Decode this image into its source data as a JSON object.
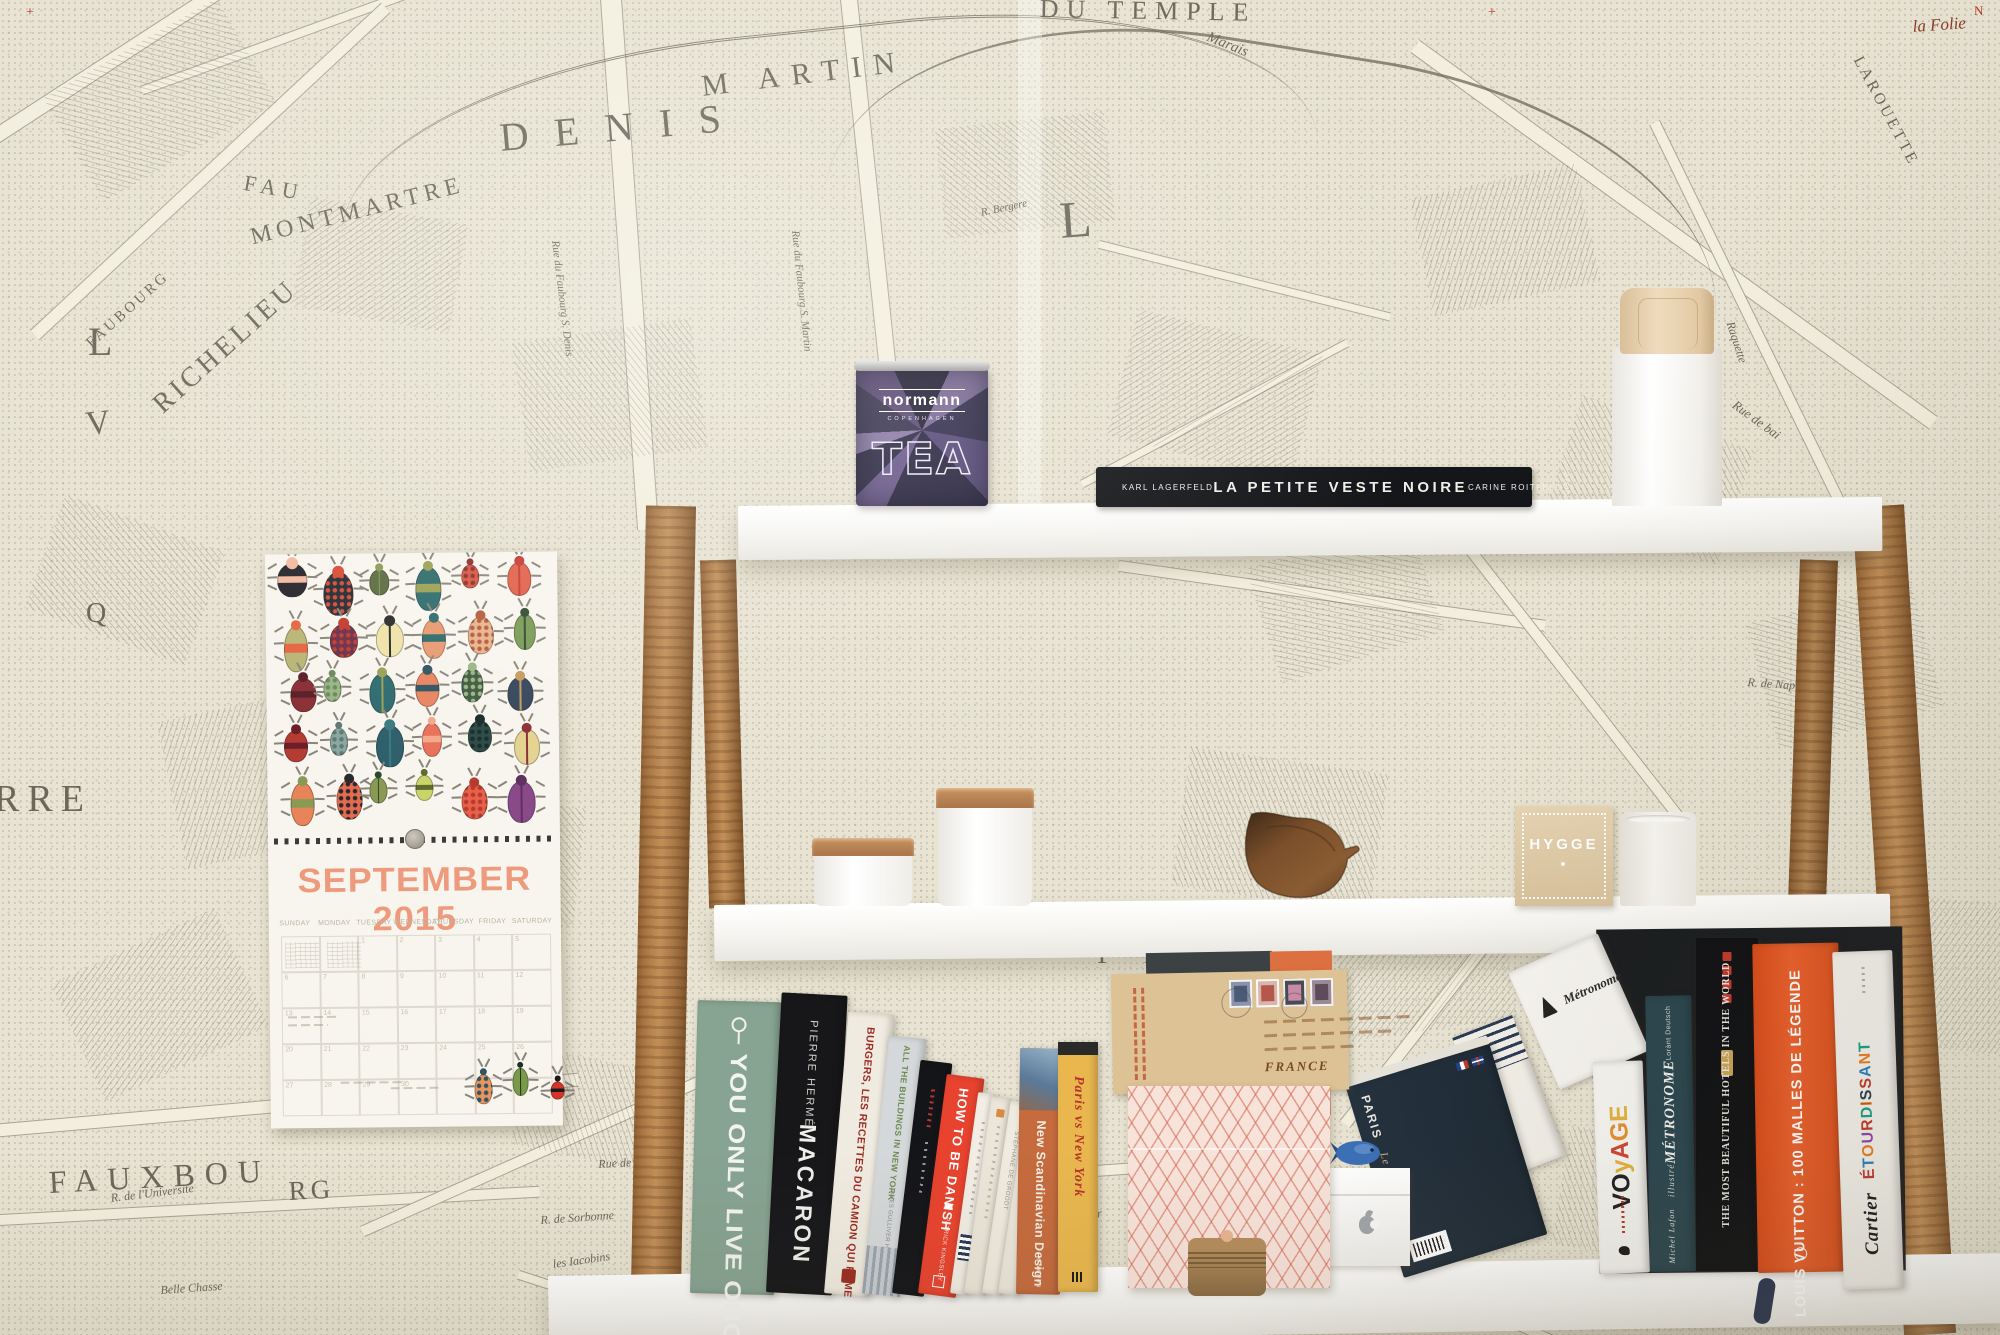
{
  "colors": {
    "wallpaper": "#e8e3d2",
    "ink": "#6b675a",
    "street": "#f3efdf",
    "plank": "#f7f6f2",
    "wood": "#b8854e",
    "calendar_title": "#ee9b7d",
    "tea_purple": "#3a3550",
    "hygge_kraft": "#dcc6a2",
    "vuitton_orange": "#e5531f",
    "danish_red": "#e8432e"
  },
  "wallpaper": {
    "labels": [
      {
        "t": "DENIS",
        "x": 498,
        "y": 118,
        "s": 40,
        "r": -5,
        "ls": 26
      },
      {
        "t": "M ARTIN",
        "x": 700,
        "y": 72,
        "s": 30,
        "r": -7,
        "ls": 12
      },
      {
        "t": "DU TEMPLE",
        "x": 1040,
        "y": -4,
        "s": 26,
        "r": 1,
        "ls": 8
      },
      {
        "t": "Marais",
        "x": 1210,
        "y": 30,
        "s": 15,
        "r": 22,
        "i": 1
      },
      {
        "t": "MONTMARTRE",
        "x": 248,
        "y": 226,
        "s": 24,
        "r": -14,
        "ls": 5
      },
      {
        "t": "RICHELIEU",
        "x": 148,
        "y": 398,
        "s": 28,
        "r": -42,
        "ls": 4
      },
      {
        "t": "FAUBOURG",
        "x": 84,
        "y": 340,
        "s": 15,
        "r": -42,
        "ls": 3
      },
      {
        "t": "FAU",
        "x": 246,
        "y": 172,
        "s": 22,
        "r": 10,
        "ls": 6
      },
      {
        "t": "L",
        "x": 88,
        "y": 322,
        "s": 40,
        "r": 0
      },
      {
        "t": "L",
        "x": 1058,
        "y": 196,
        "s": 52,
        "r": -4
      },
      {
        "t": "V",
        "x": 84,
        "y": 408,
        "s": 34,
        "r": -6
      },
      {
        "t": "Q",
        "x": 86,
        "y": 600,
        "s": 28,
        "r": 0
      },
      {
        "t": "RRE",
        "x": -6,
        "y": 780,
        "s": 38,
        "r": 0,
        "ls": 8
      },
      {
        "t": "FAUXBOU",
        "x": 48,
        "y": 1166,
        "s": 32,
        "r": -3,
        "ls": 10
      },
      {
        "t": "RG",
        "x": 288,
        "y": 1178,
        "s": 27,
        "r": -3,
        "ls": 4
      },
      {
        "t": "U",
        "x": 1448,
        "y": 1086,
        "s": 54,
        "r": 8
      },
      {
        "t": "R.",
        "x": 1142,
        "y": 1200,
        "s": 32,
        "r": 0
      },
      {
        "t": "T",
        "x": 1330,
        "y": 1288,
        "s": 34,
        "r": 0
      },
      {
        "t": "T E",
        "x": 1094,
        "y": 942,
        "s": 26,
        "r": 0,
        "ls": 14
      },
      {
        "t": "LAROUETTE",
        "x": 1864,
        "y": 54,
        "s": 16,
        "r": 62,
        "ls": 3
      },
      {
        "t": "la Folie",
        "x": 1912,
        "y": 18,
        "s": 17,
        "r": -4,
        "i": 1,
        "c": "#8a3a28"
      },
      {
        "t": "Rue de Vernouil",
        "x": 598,
        "y": 1158,
        "s": 12,
        "r": -3,
        "i": 1
      },
      {
        "t": "R. de Sorbonne",
        "x": 540,
        "y": 1214,
        "s": 12,
        "r": -4,
        "i": 1
      },
      {
        "t": "R. de l'Universite",
        "x": 110,
        "y": 1192,
        "s": 12,
        "r": -7,
        "i": 1
      },
      {
        "t": "Belle Chasse",
        "x": 160,
        "y": 1284,
        "s": 12,
        "r": -4,
        "i": 1
      },
      {
        "t": "R. Iacob",
        "x": 850,
        "y": 1208,
        "s": 12,
        "r": -4,
        "i": 1
      },
      {
        "t": "R. du Colombier",
        "x": 1022,
        "y": 1218,
        "s": 12,
        "r": -8,
        "i": 1
      },
      {
        "t": "les Iacobins",
        "x": 552,
        "y": 1258,
        "s": 12,
        "r": -8,
        "i": 1
      },
      {
        "t": "Augustins",
        "x": 834,
        "y": 1172,
        "s": 12,
        "r": -4,
        "i": 1
      },
      {
        "t": "R. des Marais",
        "x": 1258,
        "y": 1164,
        "s": 12,
        "r": -12,
        "i": 1
      },
      {
        "t": "R. de Bussi",
        "x": 1292,
        "y": 1228,
        "s": 12,
        "r": -34,
        "i": 1
      },
      {
        "t": "Raquette",
        "x": 1736,
        "y": 320,
        "s": 12,
        "r": 72,
        "i": 1
      },
      {
        "t": "Rue de bai",
        "x": 1738,
        "y": 398,
        "s": 13,
        "r": 36,
        "i": 1
      },
      {
        "t": "R. de Naples",
        "x": 1748,
        "y": 676,
        "s": 12,
        "r": 4,
        "i": 1
      },
      {
        "t": "Rue du Faubourg S. Denis",
        "x": 560,
        "y": 240,
        "s": 11,
        "r": 83,
        "i": 1
      },
      {
        "t": "Rue du Faubourg S. Martin",
        "x": 800,
        "y": 230,
        "s": 11,
        "r": 84,
        "i": 1
      },
      {
        "t": "R. Bergere",
        "x": 980,
        "y": 208,
        "s": 11,
        "r": -12,
        "i": 1
      },
      {
        "t": "R. de Sorbet",
        "x": 1240,
        "y": 470,
        "s": 11,
        "r": 6,
        "i": 1
      },
      {
        "t": "+",
        "x": 26,
        "y": 6,
        "s": 14,
        "r": 0,
        "c": "#b5362a"
      },
      {
        "t": "+",
        "x": 1488,
        "y": 6,
        "s": 14,
        "r": 0,
        "c": "#b5362a"
      },
      {
        "t": "N",
        "x": 1974,
        "y": 4,
        "s": 13,
        "r": 0,
        "c": "#b5362a"
      }
    ]
  },
  "calendar": {
    "title": "SEPTEMBER 2015",
    "weekdays": [
      "SUNDAY",
      "MONDAY",
      "TUESDAY",
      "WEDNESDAY",
      "THURSDAY",
      "FRIDAY",
      "SATURDAY"
    ],
    "days": [
      [
        "",
        "",
        "1",
        "2",
        "3",
        "4",
        "5"
      ],
      [
        "6",
        "7",
        "8",
        "9",
        "10",
        "11",
        "12"
      ],
      [
        "13",
        "14",
        "15",
        "16",
        "17",
        "18",
        "19"
      ],
      [
        "20",
        "21",
        "22",
        "23",
        "24",
        "25",
        "26"
      ],
      [
        "27",
        "28",
        "29",
        "30",
        "",
        "",
        ""
      ]
    ],
    "beetles": [
      {
        "b": "#26242b",
        "a": "#f2b9a0",
        "w": 30,
        "h": 34
      },
      {
        "b": "#232b33",
        "a": "#d84b35",
        "w": 30,
        "h": 44
      },
      {
        "b": "#5b6b3f",
        "a": "#8a9a55",
        "w": 20,
        "h": 26
      },
      {
        "b": "#2e6b6b",
        "a": "#9aa055",
        "w": 26,
        "h": 44
      },
      {
        "b": "#d85540",
        "a": "#8a2f28",
        "w": 18,
        "h": 24
      },
      {
        "b": "#e2604a",
        "a": "#c43a30",
        "w": 24,
        "h": 34
      },
      {
        "b": "#b9b575",
        "a": "#e5653f",
        "w": 24,
        "h": 46
      },
      {
        "b": "#6b2f4a",
        "a": "#c23b2d",
        "w": 28,
        "h": 34
      },
      {
        "b": "#efe3a8",
        "a": "#2a2a2a",
        "w": 28,
        "h": 36
      },
      {
        "b": "#e89a70",
        "a": "#2e6b6b",
        "w": 24,
        "h": 40
      },
      {
        "b": "#e8b48a",
        "a": "#b55a3f",
        "w": 26,
        "h": 38
      },
      {
        "b": "#7a9a55",
        "a": "#2f4a2f",
        "w": 22,
        "h": 36
      },
      {
        "b": "#8a2f35",
        "a": "#5a1f28",
        "w": 26,
        "h": 34
      },
      {
        "b": "#9ab585",
        "a": "#6b8a5f",
        "w": 18,
        "h": 26
      },
      {
        "b": "#2e6b70",
        "a": "#9aa055",
        "w": 26,
        "h": 40
      },
      {
        "b": "#e8845f",
        "a": "#2e5560",
        "w": 24,
        "h": 36
      },
      {
        "b": "#3f5a3f",
        "a": "#9ab585",
        "w": 22,
        "h": 34
      },
      {
        "b": "#35455a",
        "a": "#c69a60",
        "w": 26,
        "h": 34
      },
      {
        "b": "#b53b35",
        "a": "#6b1f28",
        "w": 24,
        "h": 32
      },
      {
        "b": "#8aa7a0",
        "a": "#5f7a75",
        "w": 18,
        "h": 28
      },
      {
        "b": "#2e5f6b",
        "a": "#3a7a80",
        "w": 28,
        "h": 42
      },
      {
        "b": "#e8705a",
        "a": "#f2a88a",
        "w": 20,
        "h": 34
      },
      {
        "b": "#2a4a45",
        "a": "#1a2a28",
        "w": 24,
        "h": 32
      },
      {
        "b": "#e5d290",
        "a": "#8a2f35",
        "w": 26,
        "h": 36
      },
      {
        "b": "#e8845a",
        "a": "#8a9a55",
        "w": 24,
        "h": 44
      },
      {
        "b": "#e56a50",
        "a": "#2a2a2a",
        "w": 26,
        "h": 40
      },
      {
        "b": "#8a9a55",
        "a": "#2a4a2f",
        "w": 18,
        "h": 26
      },
      {
        "b": "#c9d56b",
        "a": "#5f6b2f",
        "w": 18,
        "h": 26
      },
      {
        "b": "#e8604a",
        "a": "#b53b30",
        "w": 26,
        "h": 36
      },
      {
        "b": "#8a4a8a",
        "a": "#5f2f5f",
        "w": 28,
        "h": 42
      }
    ],
    "footer_beetles": [
      {
        "b": "#e8955f",
        "a": "#2e5560",
        "w": 18,
        "h": 30
      },
      {
        "b": "#7a9a4a",
        "a": "#1f2f1f",
        "w": 16,
        "h": 28
      },
      {
        "b": "#d8352a",
        "a": "#1a1a1a",
        "w": 14,
        "h": 18
      }
    ]
  },
  "top_shelf": {
    "tea_box": {
      "brand": "normann",
      "sub": "COPENHAGEN",
      "label": "TEA"
    },
    "black_book": {
      "author_left": "KARL LAGERFELD",
      "title": "LA PETITE VESTE NOIRE",
      "author_right": "CARINE ROITFELD",
      "publisher": "STEIDL"
    }
  },
  "middle_shelf": {
    "hygge_box": {
      "label": "HYGGE"
    }
  },
  "envelope": {
    "postmark_line1": "AIR MAIL",
    "postmark_line2": "PAR AVION",
    "country": "FRANCE"
  },
  "books_left": [
    {
      "id": "yolo",
      "title": "YOU ONLY LIVE ONCE",
      "bg": "#87a391",
      "fg": "#f4f4ef"
    },
    {
      "id": "macaron",
      "author": "PIERRE HERMÉ",
      "title": "MACARON",
      "bg": "#17171a",
      "fg": "#eeeeea"
    },
    {
      "id": "burgers",
      "title": "BURGERS, LES RECETTES DU CAMION QUI FUME",
      "bg": "#f0ebe0",
      "fg": "#9c2c21"
    },
    {
      "id": "buildings",
      "title": "ALL THE BUILDINGS IN NEW YORK",
      "author": "JAMES GULLIVER HANCOCK",
      "bg": "#d5d8da",
      "fg": "#6b8a4f"
    },
    {
      "id": "thinblack",
      "title": "",
      "bg": "#141519",
      "fg": "#b5382a"
    },
    {
      "id": "danish",
      "title": "HOW TO BE DANISH",
      "author": "PATRICK KINGSLEY",
      "bg": "#e8432e",
      "fg": "#ffffff"
    },
    {
      "id": "cream1",
      "title": "",
      "bg": "#f2eee5",
      "fg": "#b0a995"
    },
    {
      "id": "cream2",
      "title": "",
      "bg": "#ebe6d9",
      "fg": "#b0a995"
    },
    {
      "id": "cream3",
      "title": "STÉPHANE DE GROODT",
      "bg": "#f0ebe0",
      "fg": "#9a9488"
    },
    {
      "id": "cream4",
      "title": "",
      "bg": "#ece7db",
      "fg": "#b0a995"
    },
    {
      "id": "scandi",
      "title": "New Scandinavian Design",
      "publisher": "teNeues",
      "bg": "#c56b3e",
      "fg": "#f5efe6"
    },
    {
      "id": "parisny",
      "title": "Paris vs New York",
      "bg": "#e9b74e",
      "fg": "#b5352a"
    }
  ],
  "books_right": [
    {
      "id": "parismanuel",
      "title": "PARIS",
      "subtitle": "Le Manuel",
      "bg": "#233240",
      "fg": "#e8e6dd"
    },
    {
      "id": "stripes",
      "title": "",
      "bg": "#f2efe8",
      "accent": "#e8843f"
    },
    {
      "id": "metrowhite",
      "title": "Métronome",
      "bg": "#f6f4ef",
      "fg": "#2a2a2a"
    },
    {
      "id": "voyage",
      "letters": [
        [
          "V",
          "#1f1f22"
        ],
        [
          "O",
          "#1f1f22"
        ],
        [
          "y",
          "#e3b23c"
        ],
        [
          "A",
          "#cf4430"
        ],
        [
          "G",
          "#e3902f"
        ],
        [
          "E",
          "#e3b23c"
        ]
      ],
      "bg": "#f6f5f1"
    },
    {
      "id": "metroteal",
      "author": "Lorànt Deutsch",
      "title": "MÉTRONOME",
      "subtitle": "illustré",
      "publisher": "Michel Lafon",
      "bg": "#2a454e",
      "fg": "#f2f2ee"
    },
    {
      "id": "hotels",
      "title": "THE MOST BEAUTIFUL HOTELS IN THE WORLD",
      "bg": "#0f1013",
      "fg": "#e8e6e0",
      "accent": "#c0392b"
    },
    {
      "id": "vuitton",
      "title": "LOUIS VUITTON : 100 MALLES DE LÉGENDE",
      "bg": "#e5531f",
      "fg": "#ffffff"
    },
    {
      "id": "cartier",
      "letters": [
        [
          "É",
          "#c0392b"
        ],
        [
          "T",
          "#2980b9"
        ],
        [
          "O",
          "#e67e22"
        ],
        [
          "U",
          "#8e44ad"
        ],
        [
          "R",
          "#c0392b"
        ],
        [
          "D",
          "#16a085"
        ],
        [
          "I",
          "#d35400"
        ],
        [
          "S",
          "#2c3e50"
        ],
        [
          "S",
          "#c0392b"
        ],
        [
          "A",
          "#2980b9"
        ],
        [
          "N",
          "#e67e22"
        ],
        [
          "T",
          "#16a085"
        ]
      ],
      "subtitle": "Cartier",
      "bg": "#f2f0ea",
      "fg": "#1a1a1a"
    }
  ]
}
